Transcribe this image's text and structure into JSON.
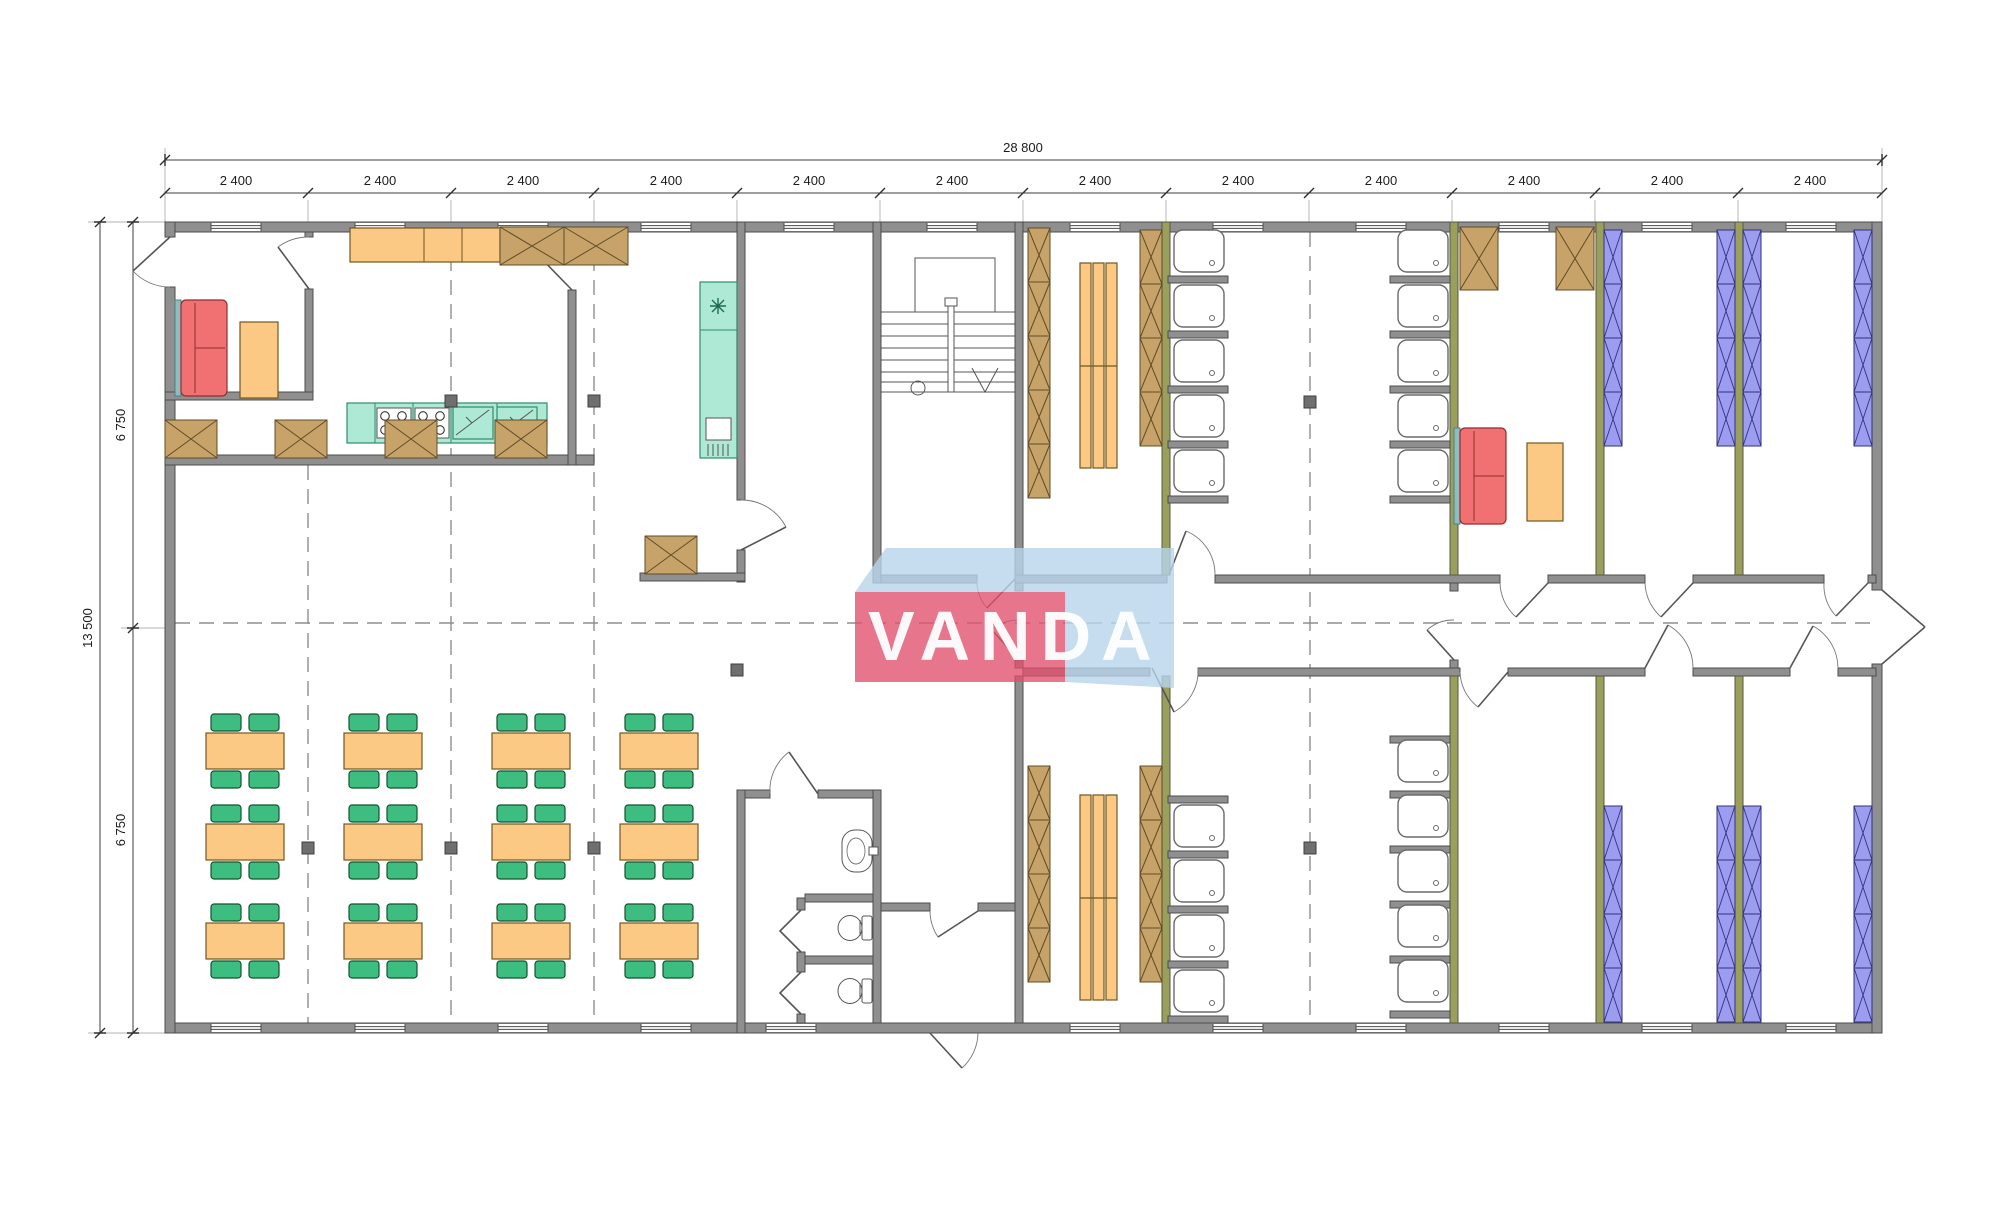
{
  "watermark": {
    "text": "VANDA"
  },
  "dimensions": {
    "top_total": "28 800",
    "top_segments": [
      "2 400",
      "2 400",
      "2 400",
      "2 400",
      "2 400",
      "2 400",
      "2 400",
      "2 400",
      "2 400",
      "2 400",
      "2 400",
      "2 400"
    ],
    "left_total": "13 500",
    "left_segments": [
      "6 750",
      "6 750"
    ]
  },
  "colors": {
    "wall_gray": "#8f8f8f",
    "partition_green": "#9aa05c",
    "furniture_orange": "#fcc985",
    "chair_green": "#3dbd80",
    "locker_brown": "#c7a269",
    "bunk_purple": "#9c9cf0",
    "sofa_red": "#f17173",
    "kitchen_mint": "#aee9d6",
    "watermark_red": "#e0506b",
    "watermark_blue": "#b6d4ea"
  },
  "icons": {
    "freezer": "snowflake"
  }
}
